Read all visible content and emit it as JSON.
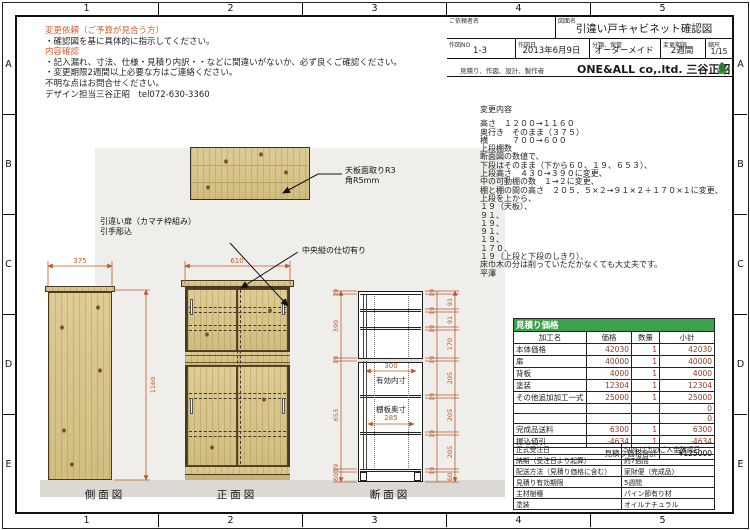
{
  "colors": {
    "dim_line": "#bf5a27",
    "notice_red": "#e05c2d",
    "table_header_green": "#3ba24b"
  },
  "frame": {
    "cols": [
      "1",
      "2",
      "3",
      "4",
      "5"
    ],
    "rows": [
      "A",
      "B",
      "C",
      "D",
      "E"
    ]
  },
  "notice": {
    "l1": "変更依頼（ご予算が見合う方）",
    "l2": "・確認図を基に具体的に指示してください。",
    "l3": "内容確認",
    "l4": "・記入漏れ、寸法、仕様・見積り内訳・・などに間違いがないか、必ず良くご確認ください。",
    "l5": "・変更期限2週間以上必要な方はご連絡ください。",
    "l6": "不明な点はお問合せください。",
    "l7": "デザイン担当三谷正昭　tel072-630-3360"
  },
  "title_block": {
    "client_label": "ご依頼者名",
    "client_value": "",
    "drawing_label": "図面名",
    "drawing_value": "引違い戸キャビネット確認図",
    "no_label": "作図NO",
    "no_value": "1-3",
    "date_label": "作図日",
    "date_value": "2013年6月9日",
    "category_label": "分類、保管",
    "category_value": "オーダーメイド",
    "deadline_label": "変更期限",
    "deadline_value": "2週間",
    "scale_label": "縮尺",
    "scale_value": "1/15",
    "maker_label": "見積り、作図、設計、製作者",
    "maker_value": "ONE&ALL co,.ltd. 三谷正昭"
  },
  "changes": {
    "title": "変更内容",
    "lines": [
      "高さ　１２００→１１６０",
      "奥行き　そのまま（３７５）",
      "横　　　７００→６００",
      "上段棚数",
      "断面図の数値で、",
      "下段はそのまま（下から６０、１９、６５３）、",
      "上段高さ　４３０→３９０に変更、",
      "中の可動棚の数　１→２に変更、",
      "棚と棚の間の高さ　２０５．５×２→９１×２＋１７０×１に変更、",
      "上段を上から、",
      "１９（天板）、",
      "９１、",
      "１９、",
      "９１、",
      "１９、",
      "１７０、",
      "１９（上段と下段のしきり）、",
      "床巾木の分は削っていただかなくても大丈夫です。",
      "平澤"
    ]
  },
  "estimate": {
    "title": "見積り価格",
    "headers": [
      "加工名",
      "価格",
      "数量",
      "小計"
    ],
    "rows": [
      [
        "本体価格",
        "42030",
        "1",
        "42030"
      ],
      [
        "扉",
        "40000",
        "1",
        "40000"
      ],
      [
        "背板",
        "4000",
        "1",
        "4000"
      ],
      [
        "塗装",
        "12304",
        "1",
        "12304"
      ],
      [
        "その他追加加工一式",
        "25000",
        "1",
        "25000"
      ],
      [
        "",
        "",
        "",
        "0"
      ],
      [
        "",
        "",
        "",
        "0"
      ],
      [
        "完成品送料",
        "6300",
        "1",
        "6300"
      ],
      [
        "振込値引",
        "-4634",
        "1",
        "-4634"
      ]
    ],
    "total_label": "見積り価格合計",
    "total_value": "¥125000",
    "info": [
      [
        "正式受注日",
        "50%以上のご入金確認日"
      ],
      [
        "納期（受注日より起算）",
        "約7週間"
      ],
      [
        "配送方法（見積り価格に含む）",
        "家財便（完成品）"
      ],
      [
        "見積り有効期限",
        "5週間"
      ],
      [
        "主材樹種",
        "パイン節有り材"
      ],
      [
        "塗装",
        "オイルナチュラル"
      ]
    ]
  },
  "callouts": {
    "top1": "天板面取りR3",
    "top2": "角R5mm",
    "door1": "引違い扉（カマチ枠組み）",
    "door2": "引手彫込",
    "center": "中央縦の仕切有り"
  },
  "views": {
    "side": "側面図",
    "front": "正面図",
    "section": "断面図"
  },
  "dims": {
    "side_w": "375",
    "side_h": "1160",
    "front_w": "610",
    "sec_left": [
      "19",
      "390",
      "19",
      "653",
      "19",
      "60"
    ],
    "sec_right_thin": [
      "19",
      "19",
      "19",
      "19",
      "19",
      "19",
      "19"
    ],
    "sec_right_span": [
      "91",
      "91",
      "170",
      "205",
      "205",
      "205",
      "60"
    ],
    "inner_depth": "300",
    "inner_depth_label": "有効内寸",
    "shelf_depth": "285",
    "shelf_depth_label": "棚板奥寸"
  }
}
